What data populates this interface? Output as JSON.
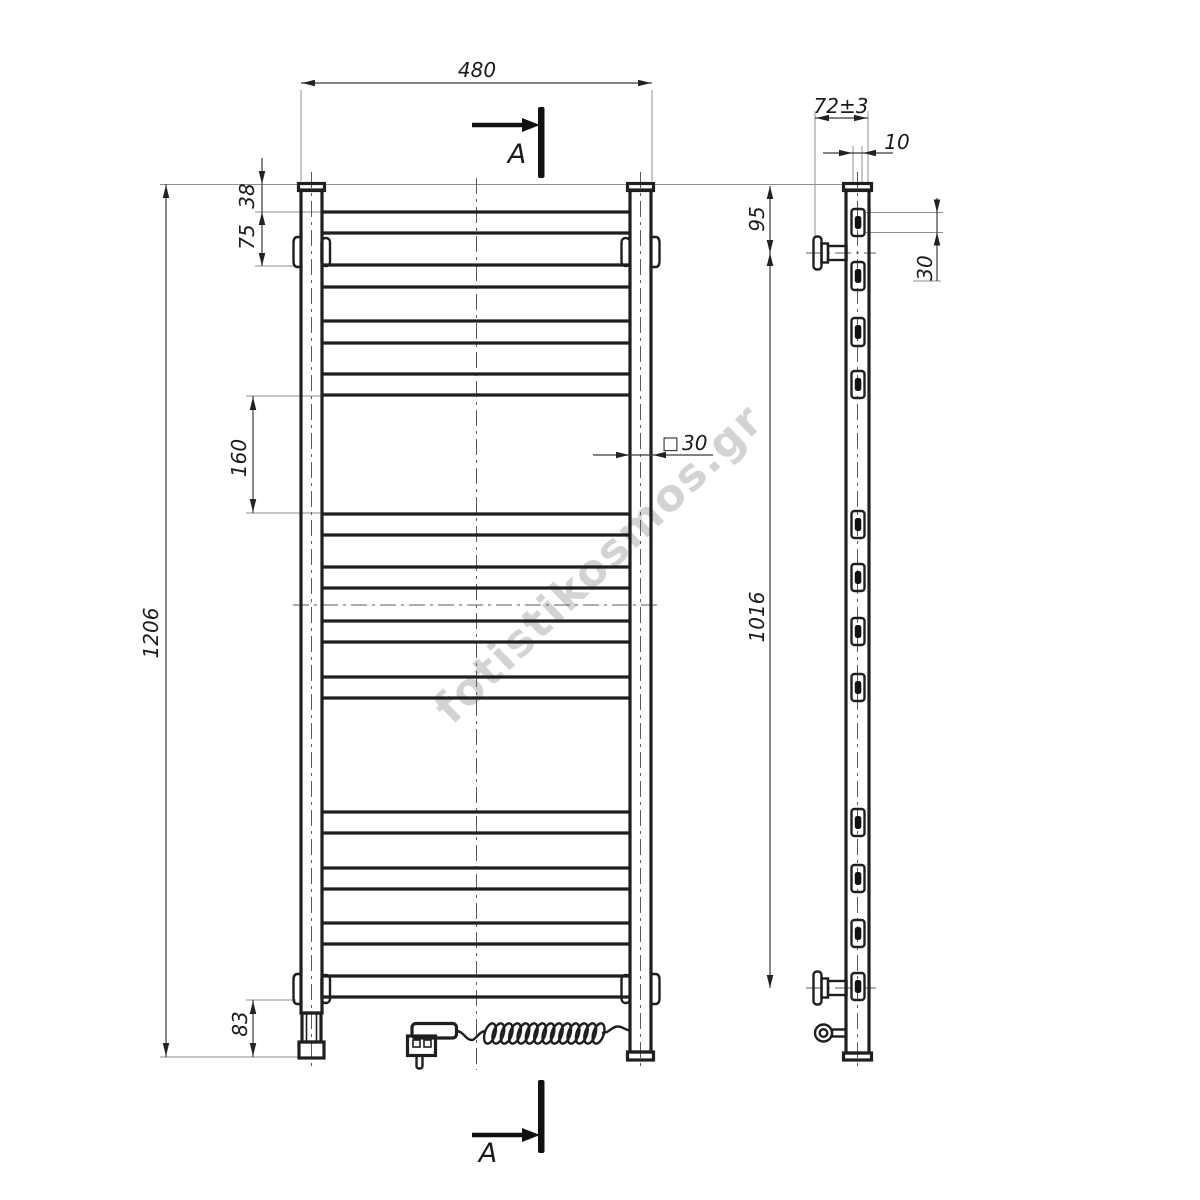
{
  "watermark": {
    "text": "fotistikosmos.gr"
  },
  "section": {
    "top_label": "A",
    "bottom_label": "A"
  },
  "front_view": {
    "width": "480",
    "height": "1206",
    "top_to_first_rung": "38",
    "first_rung_to_bracket": "75",
    "middle_gap": "160",
    "bottom_offset": "83",
    "tube_symbol": "□",
    "tube_size": "30"
  },
  "side_view": {
    "depth_to_wall": "72±3",
    "rung_inset": "10",
    "top_to_bracket": "95",
    "rung_height": "30",
    "bracket_span": "1016"
  }
}
